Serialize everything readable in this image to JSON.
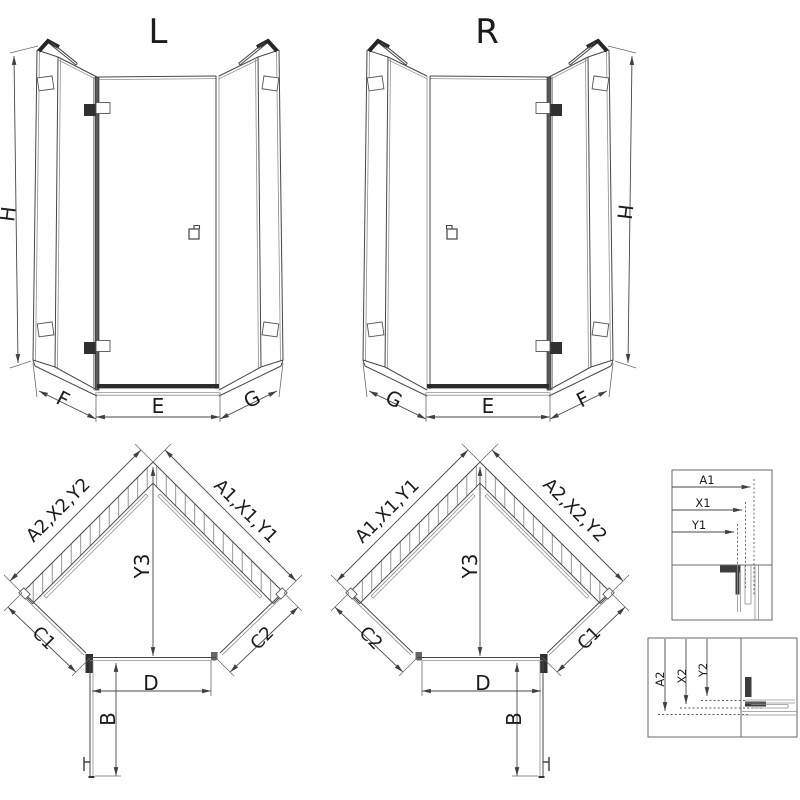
{
  "drawing": {
    "title_hint": "pentagonal shower enclosure dimensional drawing",
    "views": {
      "elevation_left": {
        "title": "L",
        "height_label": "H",
        "bottom_left_label": "F",
        "bottom_center_label": "E",
        "bottom_right_label": "G"
      },
      "elevation_right": {
        "title": "R",
        "height_label": "H",
        "bottom_left_label": "G",
        "bottom_center_label": "E",
        "bottom_right_label": "F"
      },
      "plan_left": {
        "left_wall_label": "A2,X2,Y2",
        "right_wall_label": "A1,X1,Y1",
        "depth_label": "Y3",
        "left_side_label": "C1",
        "right_side_label": "C2",
        "door_width_label": "D",
        "door_open_label": "B"
      },
      "plan_right": {
        "left_wall_label": "A1,X1,Y1",
        "right_wall_label": "A2,X2,Y2",
        "depth_label": "Y3",
        "left_side_label": "C2",
        "right_side_label": "C1",
        "door_width_label": "D",
        "door_open_label": "B"
      },
      "detail_top": {
        "labels": [
          "A1",
          "X1",
          "Y1"
        ]
      },
      "detail_bottom": {
        "labels": [
          "A2",
          "X2",
          "Y2"
        ]
      }
    },
    "colors": {
      "line": "#474747",
      "line_dark": "#262626",
      "line_light": "#8f8f8f",
      "hatch": "#8a8a8a",
      "background": "#ffffff"
    }
  }
}
